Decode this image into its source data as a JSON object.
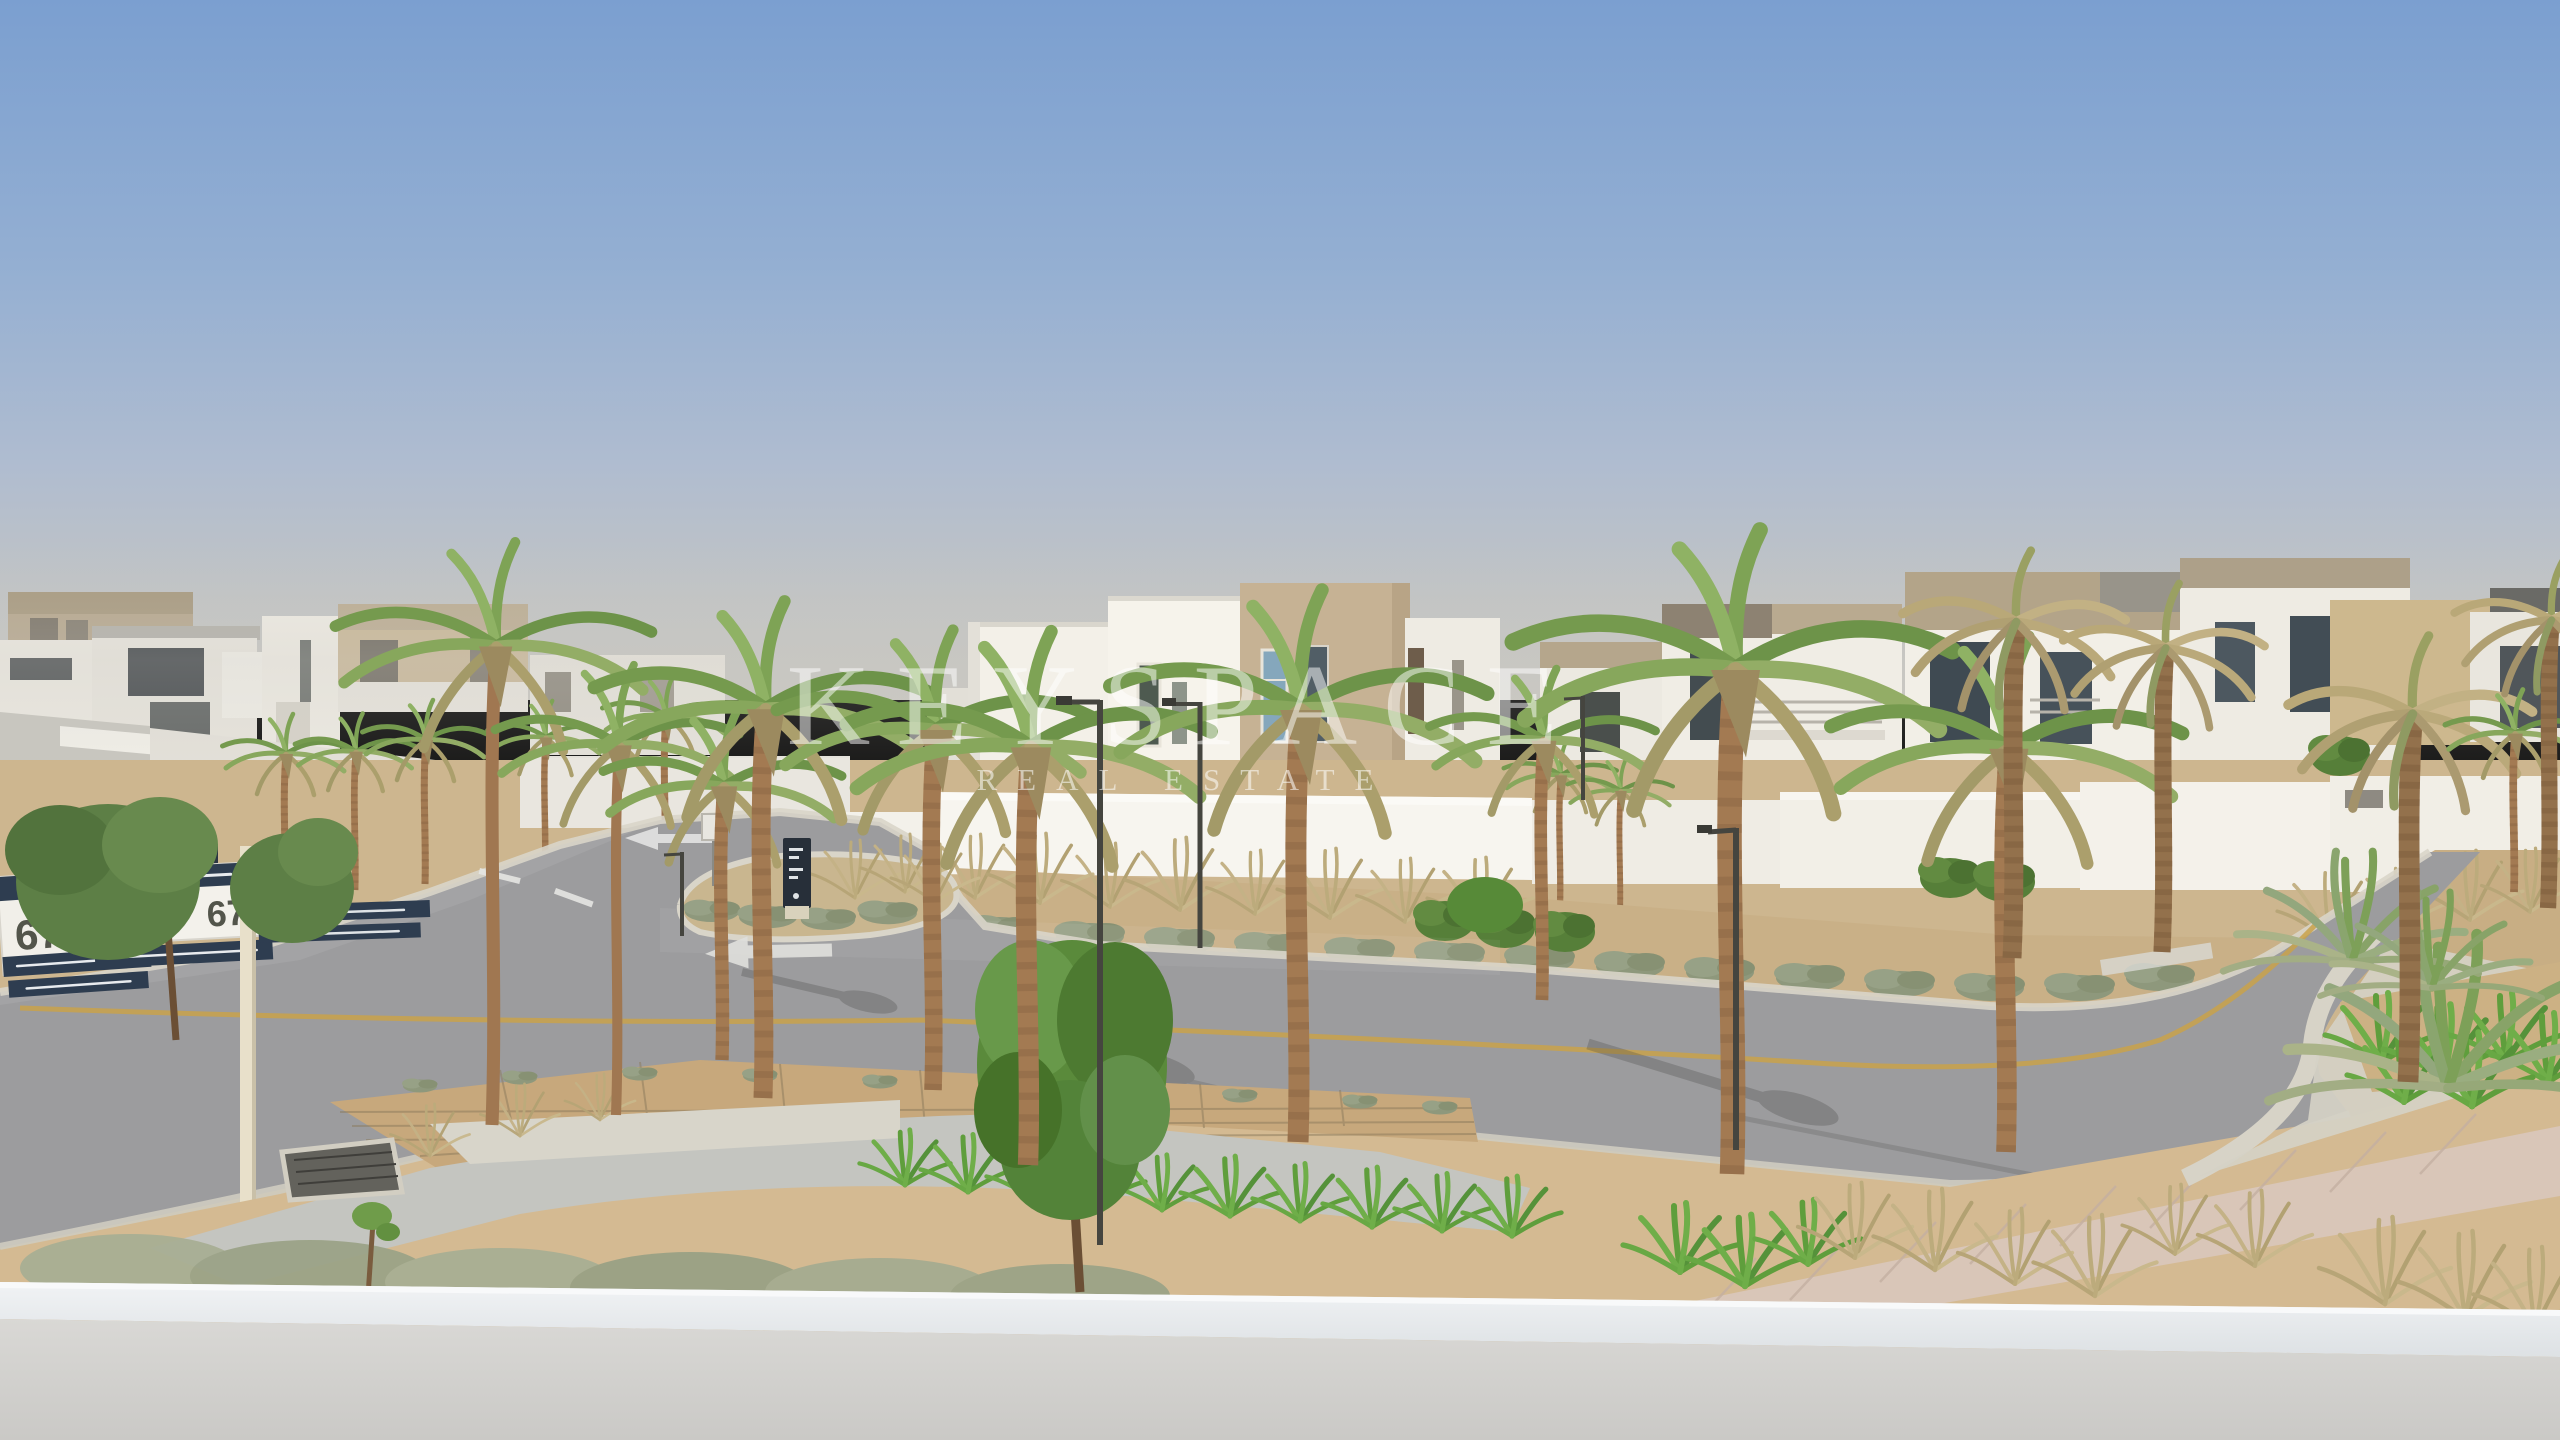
{
  "scene": {
    "description": "Elevated balcony view over a modern desert villa community with palm-lined curving streets, landscaped medians and a hazy blue sky",
    "time_of_day": "hazy daylight",
    "foreground": "white balcony parapet wall",
    "signage_language": "Arabic and English"
  },
  "watermark": {
    "brand": "KEYSPACE",
    "tagline": "REAL ESTATE"
  },
  "street_signs": {
    "far_sign_number": "676",
    "far_sign_label": "Street",
    "near_sign_number": "676",
    "near_sign_label": "Street"
  },
  "palette": {
    "sky_top": "#7b9fd0",
    "sky_horizon": "#c6c5c0",
    "villa_white": "#f0ede5",
    "villa_beige": "#c4b193",
    "roof_taupe": "#b2a287",
    "asphalt": "#9c9c9e",
    "center_line_yellow": "#c9a24a",
    "sand": "#cdb68f",
    "palm_green": "#7c9f55",
    "palm_dry": "#b6a476",
    "grass_green": "#5f9e3c",
    "sign_navy": "#2e3d50",
    "monolith_navy": "#272f39",
    "parapet_grey": "#d5d4d1",
    "hivis_yellow": "#ccd63f",
    "glass_blue": "#84a6bb"
  }
}
